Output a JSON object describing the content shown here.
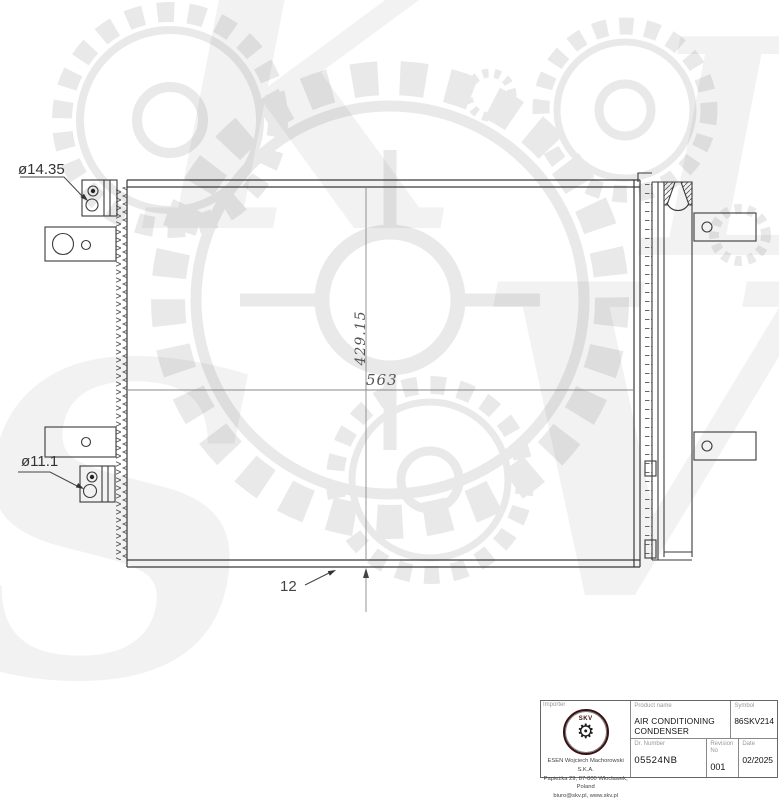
{
  "watermark": {
    "letters": [
      "S",
      "K",
      "V",
      "L"
    ]
  },
  "drawing": {
    "dimensions": {
      "top_fitting": "ø14.35",
      "bottom_fitting": "ø11.1",
      "height": "429.15",
      "width": "563",
      "depth": "12"
    }
  },
  "title_block": {
    "importer": {
      "label": "Importer",
      "company": "ESEN Wojciech Machorowski S.K.A.",
      "address": "Papieżka 29, 87-800 Włocławek, Poland",
      "contact": "biuro@skv.pl, www.skv.pl"
    },
    "logo": {
      "text": "SKV",
      "gear_glyph": "⚙"
    },
    "product": {
      "label": "Product name",
      "value": "AIR CONDITIONING CONDENSER"
    },
    "symbol": {
      "label": "Symbol",
      "value": "86SKV214"
    },
    "dr_number": {
      "label": "Dr. Number",
      "value": "05524NB"
    },
    "revision": {
      "label": "Revision No",
      "value": "001"
    },
    "date": {
      "label": "Date",
      "value": "02/2025"
    }
  }
}
